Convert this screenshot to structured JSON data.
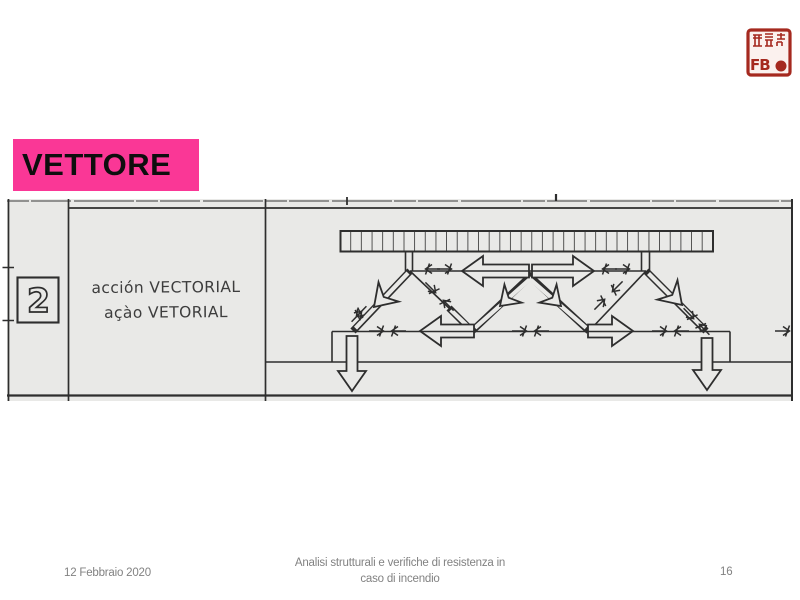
{
  "slide": {
    "title": "VETTORE",
    "footer": {
      "date": "12 Febbraio 2020",
      "subject_line1": "Analisi strutturali e verifiche di resistenza in",
      "subject_line2": "caso di incendio",
      "page_number": "16"
    },
    "stamp_monogram": "FB"
  },
  "sketch": {
    "index_label": "2",
    "caption_line1": "acción VECTORIAL",
    "caption_line2": "açào VETORIAL"
  },
  "colors": {
    "accent_pink": "#fa3796",
    "stamp_red": "#a5291f",
    "sketch_paper": "#e9e9e7",
    "ink": "#2e2e2e",
    "caption_ink": "#3d3d3d",
    "footer_text": "#828282"
  }
}
